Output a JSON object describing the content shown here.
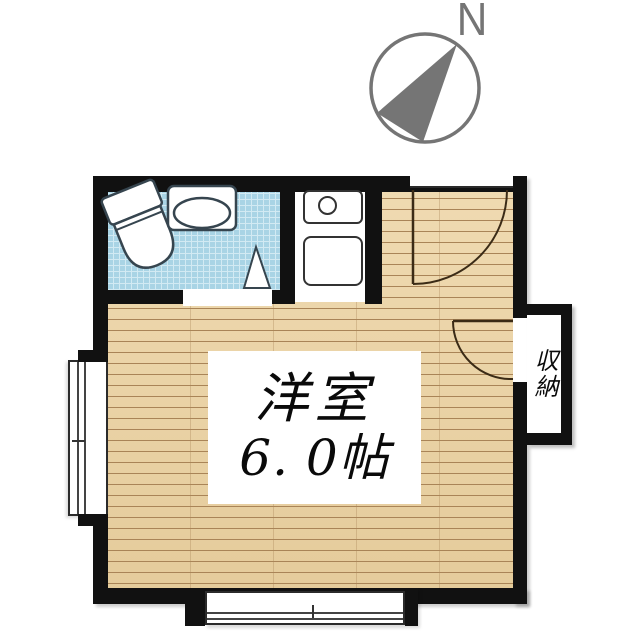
{
  "compass": {
    "north_label": "N"
  },
  "plan": {
    "main_room": {
      "name": "洋室",
      "size": "6. 0帖"
    },
    "closet": {
      "label": "収納"
    },
    "fixtures": [
      "toilet",
      "bathroom-sink",
      "folding-door",
      "stove-burner",
      "kitchen-sink",
      "entrance-door-swing",
      "closet-door-swing",
      "left-window",
      "bottom-window"
    ]
  },
  "colors": {
    "wall": "#111111",
    "wood-base": "#ecd2a0",
    "wood-line": "#a98457",
    "tile": "#a9d4e5",
    "tile-line": "#d2eaf3",
    "fixture-outline": "#36454f",
    "door-arc": "#3b2b16",
    "compass": "#757575",
    "ink": "#0a0a0a"
  }
}
